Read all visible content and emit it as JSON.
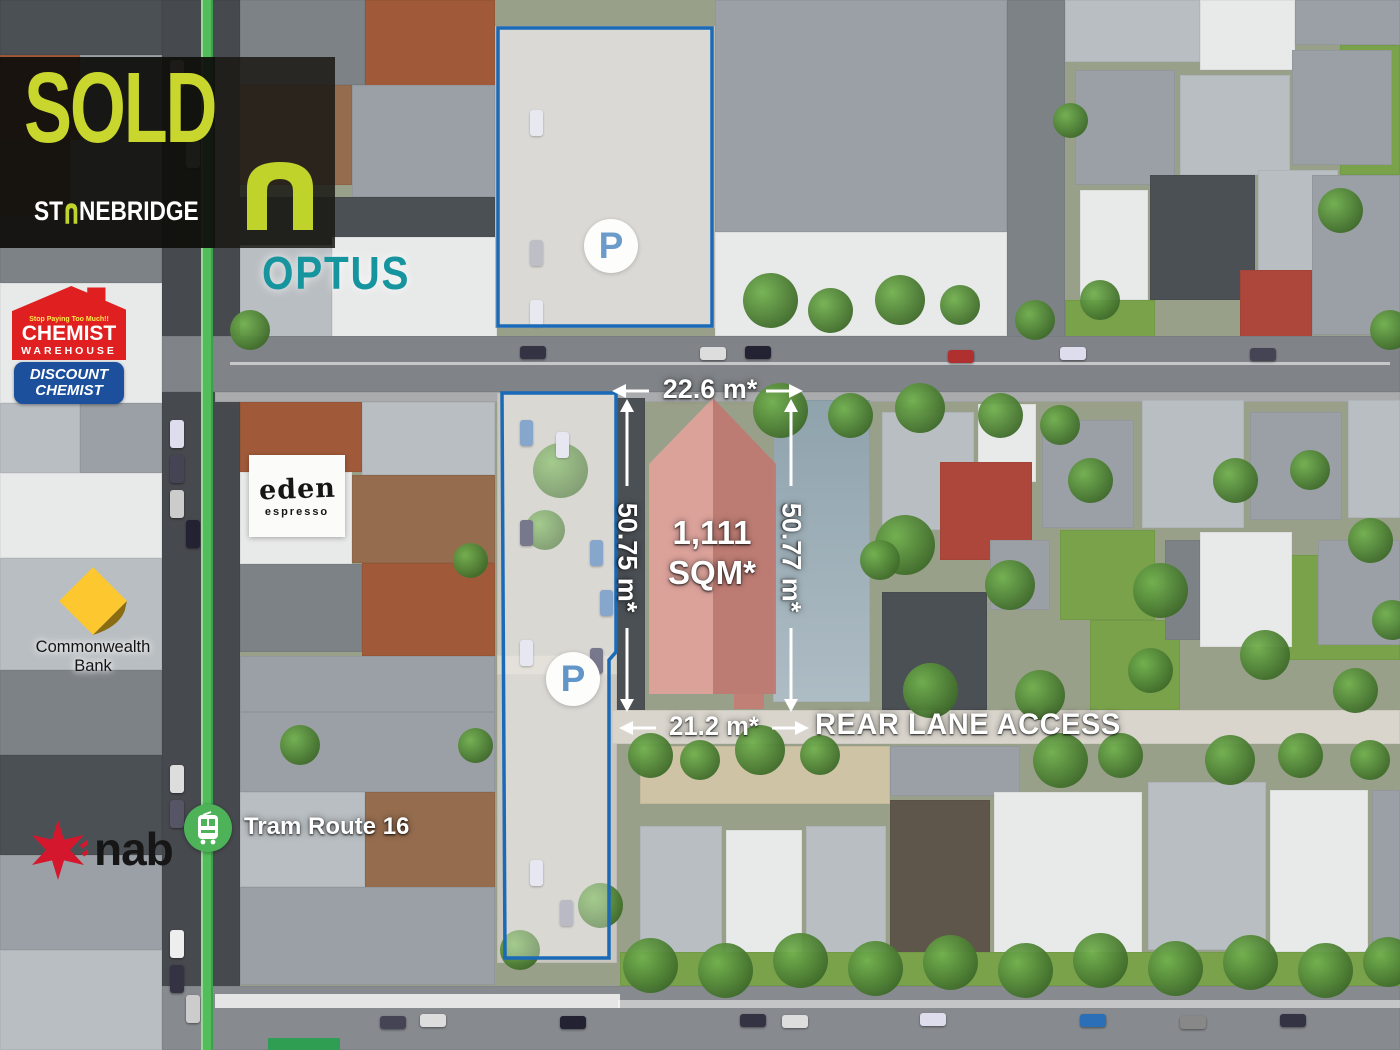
{
  "banner": {
    "status": "SOLD",
    "agency_prefix": "ST",
    "agency_suffix": "NEBRIDGE"
  },
  "property": {
    "area_line1": "1,111",
    "area_line2": "SQM*",
    "front_width": "22.6 m*",
    "left_depth": "50.75 m*",
    "right_depth": "50.77 m*",
    "rear_width": "21.2 m*",
    "rear_lane_label": "REAR LANE ACCESS"
  },
  "parking": {
    "symbol": "P"
  },
  "transport": {
    "tram_route": "Tram Route 16"
  },
  "landmarks": {
    "optus": "OPTUS",
    "chemist_warehouse": {
      "tagline": "Stop Paying Too Much!!",
      "name_line1": "CHEMIST",
      "name_line2": "WAREHOUSE",
      "sub_line1": "DISCOUNT",
      "sub_line2": "CHEMIST"
    },
    "commonwealth_bank": "Commonwealth Bank",
    "nab": "nab",
    "eden_espresso": {
      "line1": "eden",
      "line2": "espresso"
    }
  },
  "colors": {
    "sold_lime": "#c8d62e",
    "optus_teal": "#17959f",
    "outline_blue": "#1a6ab8",
    "parking_p_blue": "#1261b0",
    "tram_green": "#53bd5c",
    "chemist_red": "#e02020",
    "chemist_blue": "#1c4f9c",
    "nab_red": "#d5172e",
    "commbank_yellow": "#fdc82f",
    "property_red_light": "#e0a29c",
    "property_red_dark": "#c07770"
  }
}
